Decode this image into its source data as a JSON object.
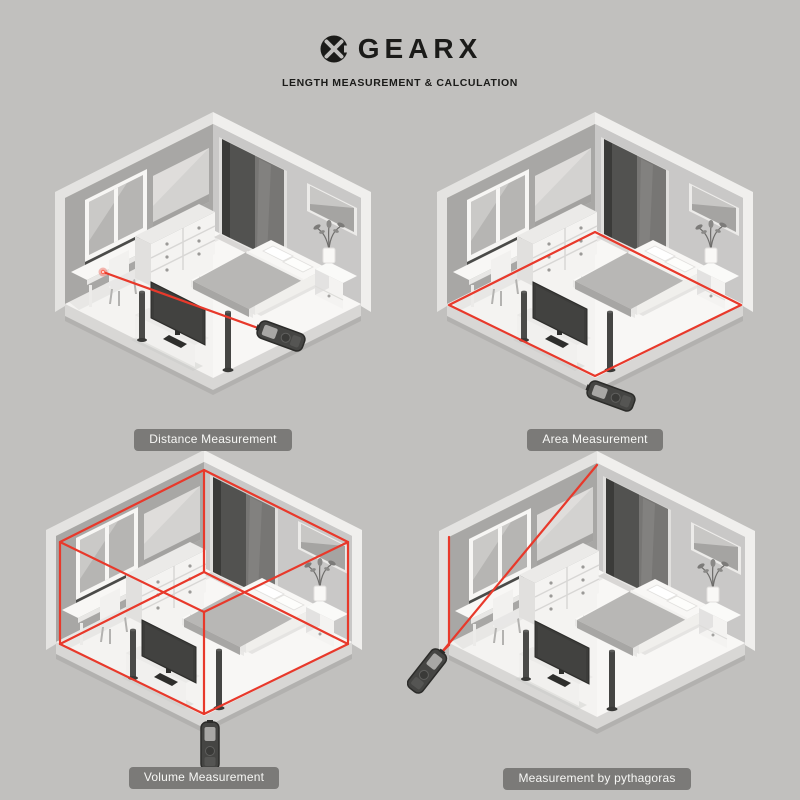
{
  "header": {
    "brand": "GEARX",
    "subtitle": "LENGTH MEASUREMENT & CALCULATION"
  },
  "panels": [
    {
      "id": "distance",
      "label": "Distance Measurement"
    },
    {
      "id": "area",
      "label": "Area Measurement"
    },
    {
      "id": "volume",
      "label": "Volume Measurement"
    },
    {
      "id": "pythagoras",
      "label": "Measurement by pythagoras"
    }
  ],
  "colors": {
    "background": "#c1c0be",
    "laser_red": "#e8392b",
    "laser_flare": "#ff6a55",
    "label_pill_bg": "#7b7a78",
    "label_pill_text": "#f7f7f5",
    "title_text": "#1b1b19"
  },
  "icons": {
    "brand_logo": "gearx-circle-x-logo",
    "device": "laser-measure-device"
  }
}
